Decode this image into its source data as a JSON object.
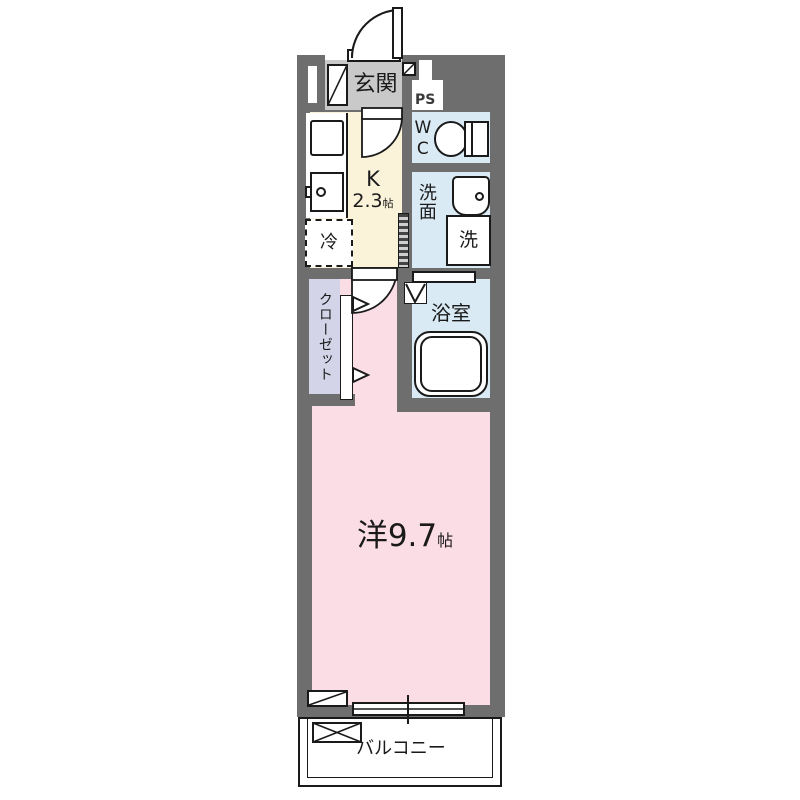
{
  "plan_title": "1K apartment floor plan",
  "colors": {
    "wall": "#6e6e6e",
    "entrance_floor": "#c9c9c9",
    "kitchen_floor": "#faf3da",
    "wet_area_floor": "#d9eaf5",
    "closet_floor": "#d4d4e9",
    "room_floor": "#fbdde6",
    "line": "#1a1a1a"
  },
  "rooms": {
    "genkan": {
      "label": "玄関"
    },
    "ps": {
      "label": "PS"
    },
    "wc": {
      "label": "WC"
    },
    "kitchen": {
      "label": "K",
      "size": "2.3",
      "size_unit": "帖"
    },
    "refrigerator": {
      "label": "冷"
    },
    "senmen": {
      "label": "洗面"
    },
    "washer": {
      "label": "洗"
    },
    "bathroom": {
      "label": "浴室"
    },
    "closet": {
      "label": "クローゼット"
    },
    "main_room": {
      "label": "洋9.7",
      "size_unit": "帖"
    },
    "balcony": {
      "label": "バルコニー"
    }
  }
}
